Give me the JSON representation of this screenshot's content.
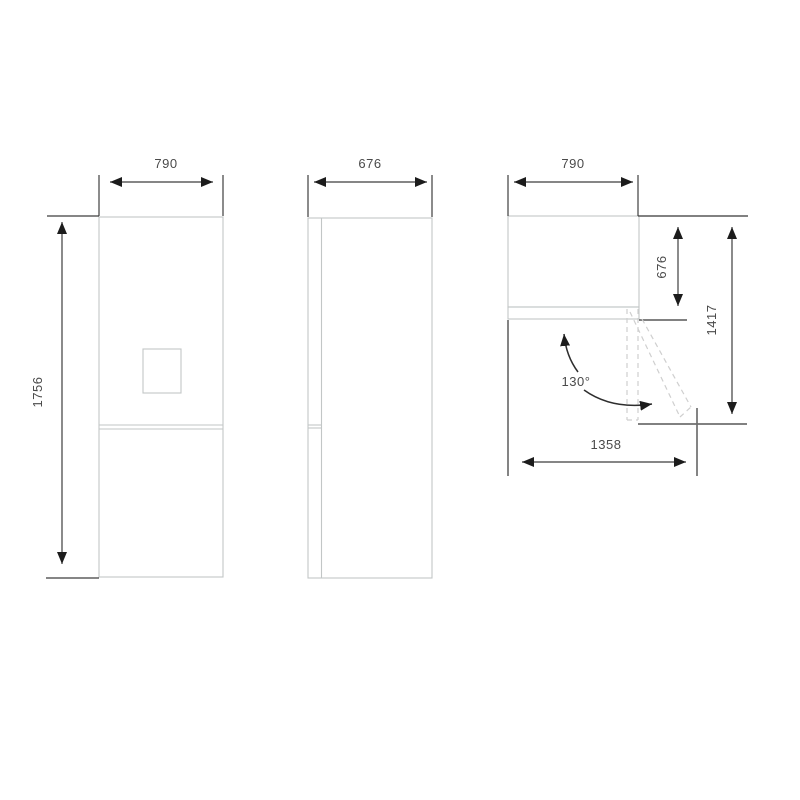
{
  "drawing": {
    "front_view": {
      "width_label": "790",
      "height_label": "1756"
    },
    "side_view": {
      "depth_label": "676"
    },
    "top_view": {
      "width_label": "790",
      "total_depth_label": "676",
      "door_open_depth_label": "1417",
      "door_open_width_label": "1358",
      "door_angle_label": "130°"
    }
  },
  "colors": {
    "outline_light": "#c2c6c6",
    "reference": "#6f6f6f",
    "dimension": "#3e3e3e",
    "dashed": "#cfcfcf",
    "text": "#4a4a4a",
    "arrow": "#1c1c1c"
  }
}
